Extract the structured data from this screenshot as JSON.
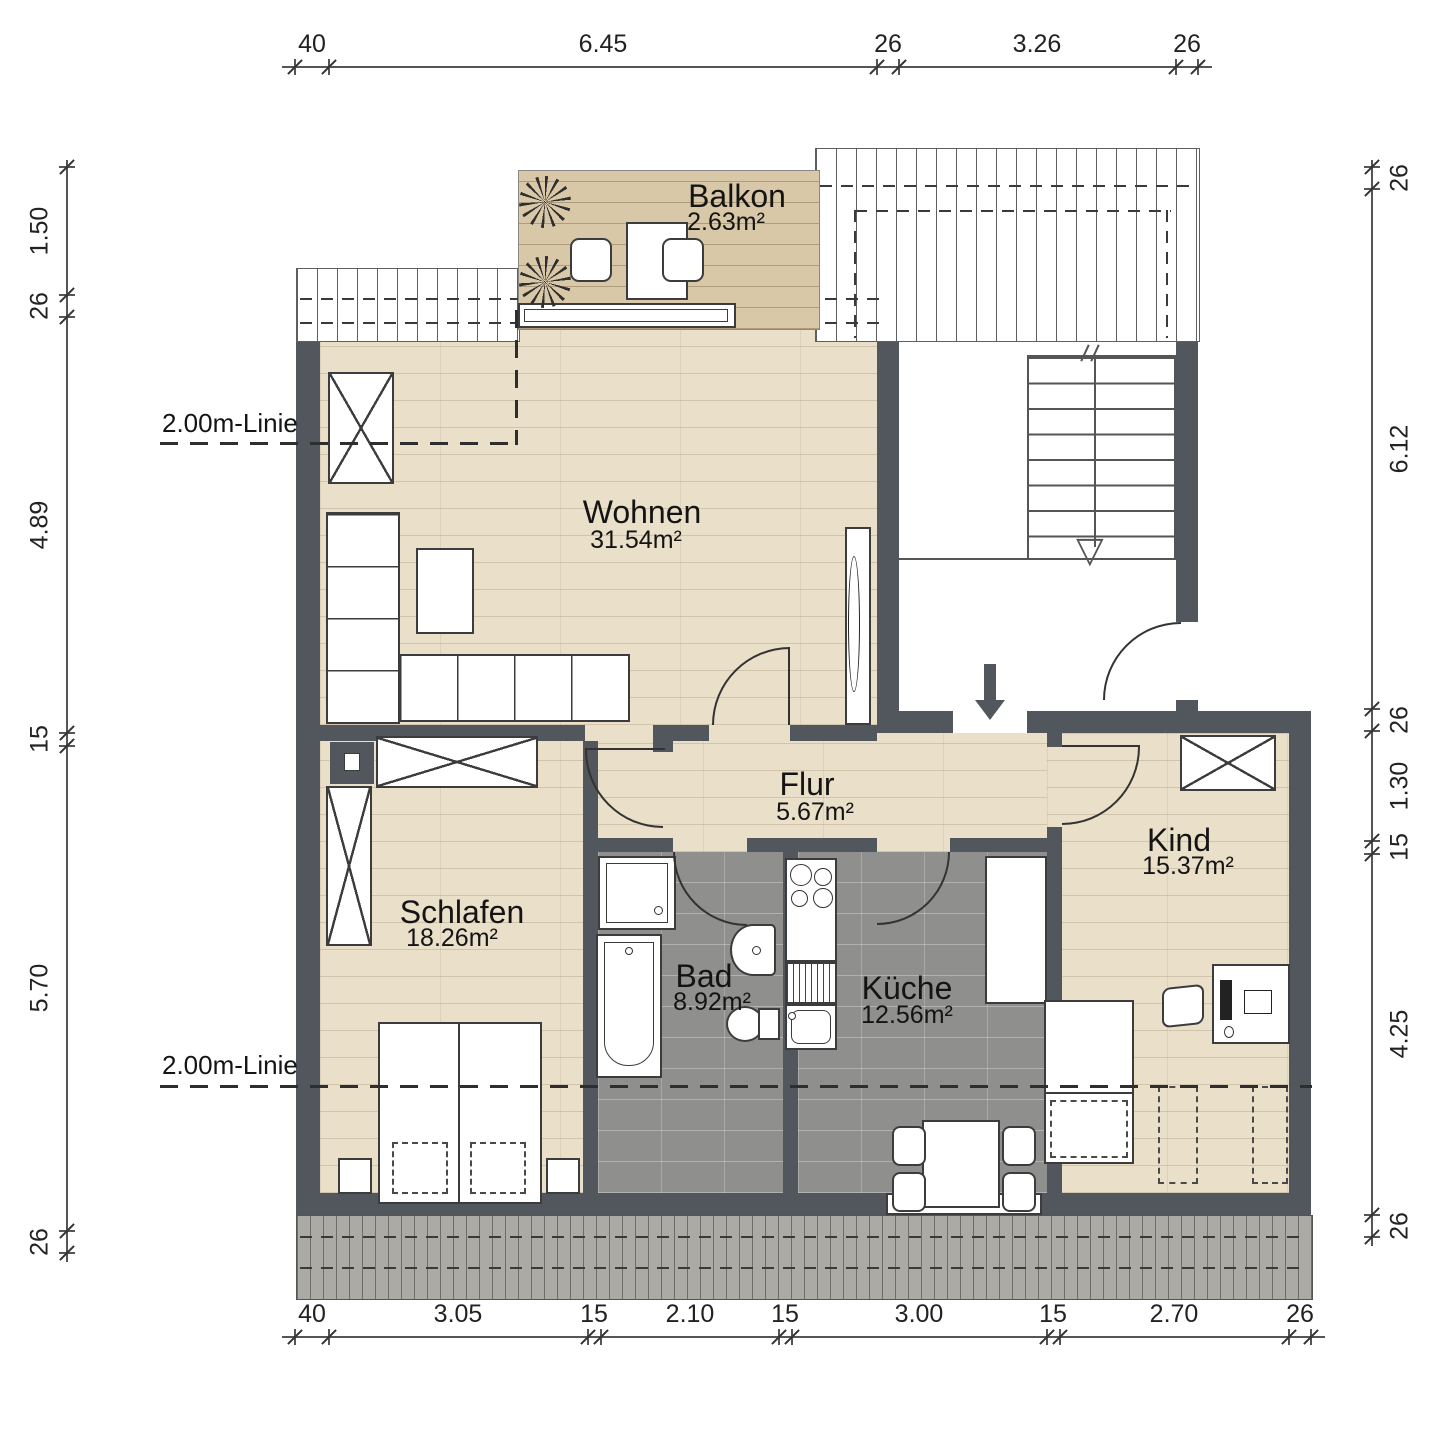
{
  "rooms": [
    {
      "name": "Balkon",
      "area": "2.63m²"
    },
    {
      "name": "Wohnen",
      "area": "31.54m²"
    },
    {
      "name": "Flur",
      "area": "5.67m²"
    },
    {
      "name": "Schlafen",
      "area": "18.26m²"
    },
    {
      "name": "Bad",
      "area": "8.92m²"
    },
    {
      "name": "Küche",
      "area": "12.56m²"
    },
    {
      "name": "Kind",
      "area": "15.37m²"
    }
  ],
  "annotations": {
    "height_line_upper": "2.00m-Linie",
    "height_line_lower": "2.00m-Linie"
  },
  "dimensions": {
    "top": [
      "40",
      "6.45",
      "26",
      "3.26",
      "26"
    ],
    "bottom": [
      "40",
      "3.05",
      "15",
      "2.10",
      "15",
      "3.00",
      "15",
      "2.70",
      "26"
    ],
    "left": [
      "1.50",
      "26",
      "4.89",
      "15",
      "5.70",
      "26"
    ],
    "right": [
      "26",
      "6.12",
      "26",
      "1.30",
      "15",
      "4.25",
      "26"
    ]
  },
  "icons": {
    "stair_direction": "▽"
  },
  "colors": {
    "wall": "#51575c",
    "wood_floor": "#eadfc9",
    "balcony_deck": "#d9c8a8",
    "tile_floor": "#8f8f8d",
    "terrace": "#abaaa5"
  }
}
